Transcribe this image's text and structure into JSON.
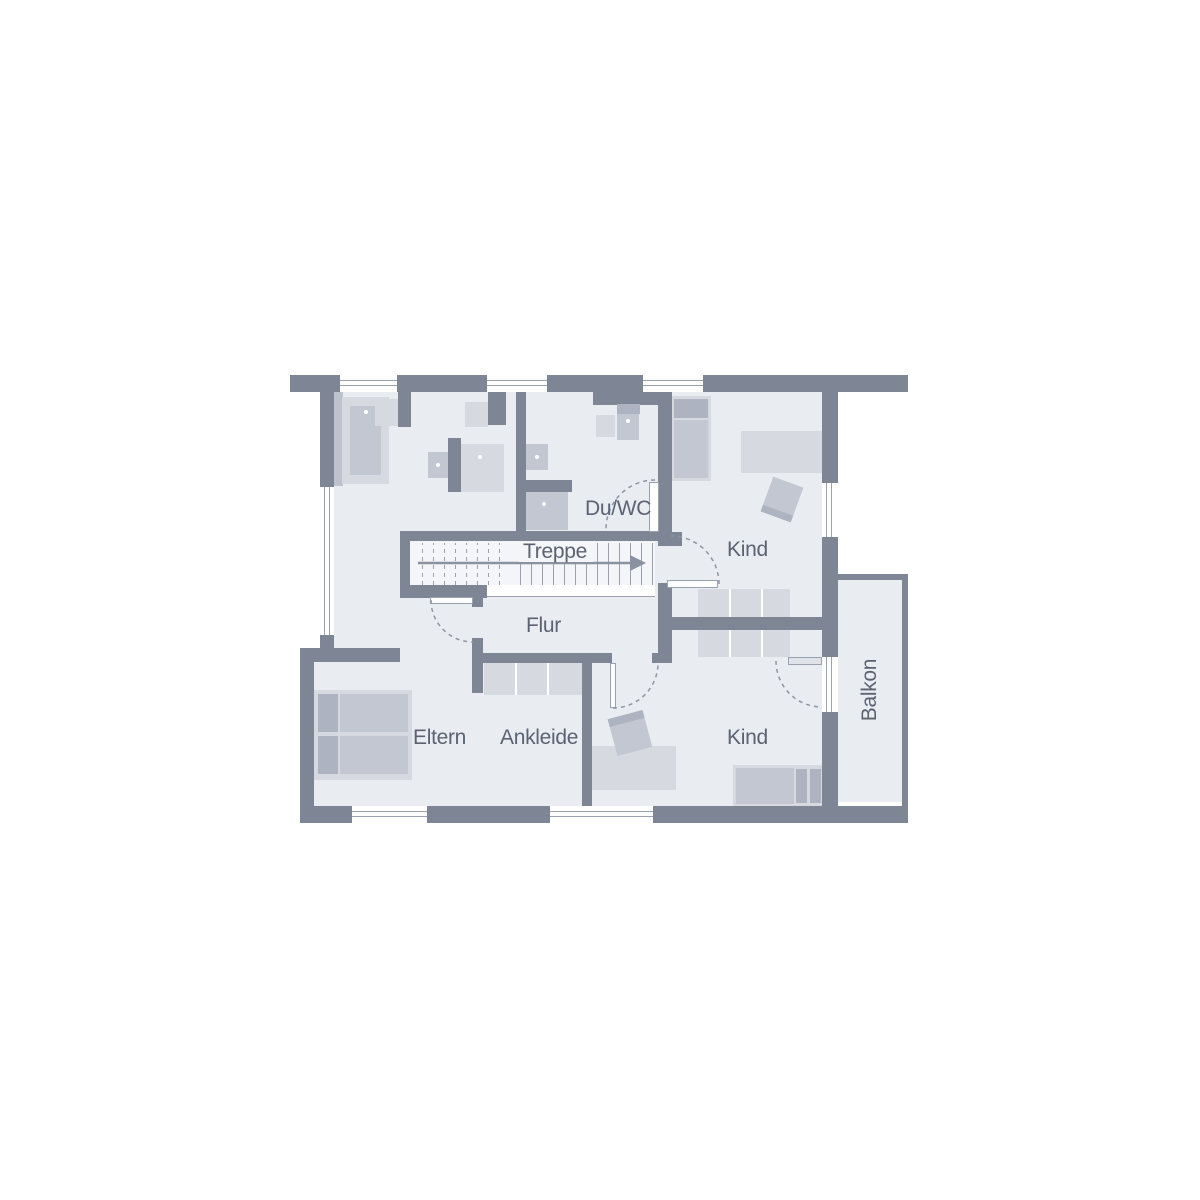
{
  "rooms": {
    "du_wc": {
      "label": "Du/WC"
    },
    "treppe": {
      "label": "Treppe"
    },
    "kind_top": {
      "label": "Kind"
    },
    "flur": {
      "label": "Flur"
    },
    "eltern": {
      "label": "Eltern"
    },
    "ankleide": {
      "label": "Ankleide"
    },
    "kind_bottom": {
      "label": "Kind"
    },
    "balkon": {
      "label": "Balkon"
    }
  },
  "colors": {
    "wall": "#7e8696",
    "floor": "#e9ecf1",
    "furn-light": "#d6d9e0",
    "furn-med": "#c2c7d1",
    "furn-dark": "#adb3c0",
    "line": "#9ba2af",
    "text": "#5b6272",
    "stairs": "#f4f5f8"
  }
}
